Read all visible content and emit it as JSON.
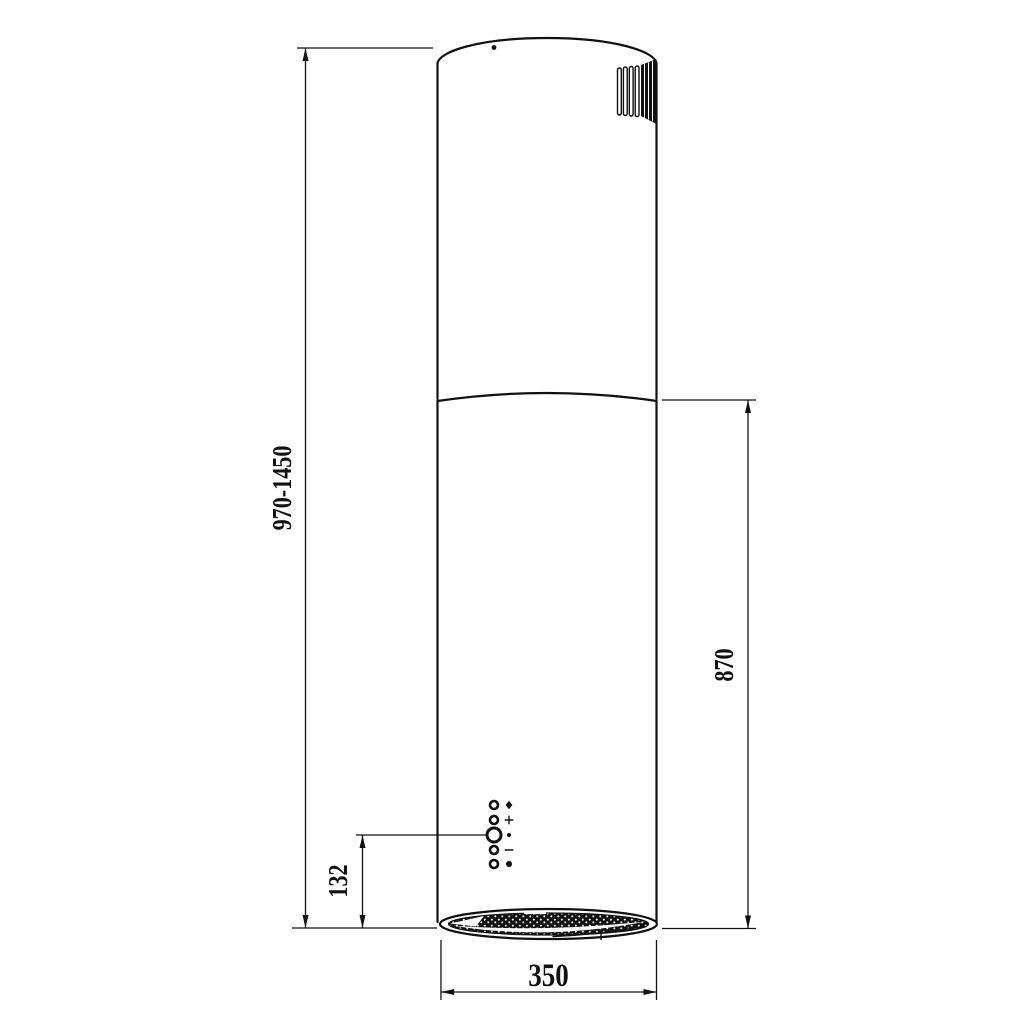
{
  "drawing": {
    "type": "technical-dimension-drawing",
    "subject": "cylindrical-island-cooker-hood",
    "colors": {
      "line": "#111111",
      "background": "#ffffff"
    },
    "dimensions": {
      "total_height_range": {
        "label": "970-1450",
        "orientation": "vertical",
        "side": "left"
      },
      "body_height": {
        "label": "870",
        "orientation": "vertical",
        "side": "right"
      },
      "control_panel_offset": {
        "label": "132",
        "orientation": "vertical",
        "side": "lower-left"
      },
      "body_diameter": {
        "label": "350",
        "orientation": "horizontal",
        "side": "bottom"
      }
    },
    "controls": {
      "buttons": [
        {
          "symbol": "diamond"
        },
        {
          "symbol": "plus"
        },
        {
          "symbol": "dot"
        },
        {
          "symbol": "minus"
        },
        {
          "symbol": "filled-dot"
        }
      ]
    },
    "features": [
      "exhaust-vent-grille",
      "alignment-dot",
      "grease-filter-mesh"
    ]
  }
}
